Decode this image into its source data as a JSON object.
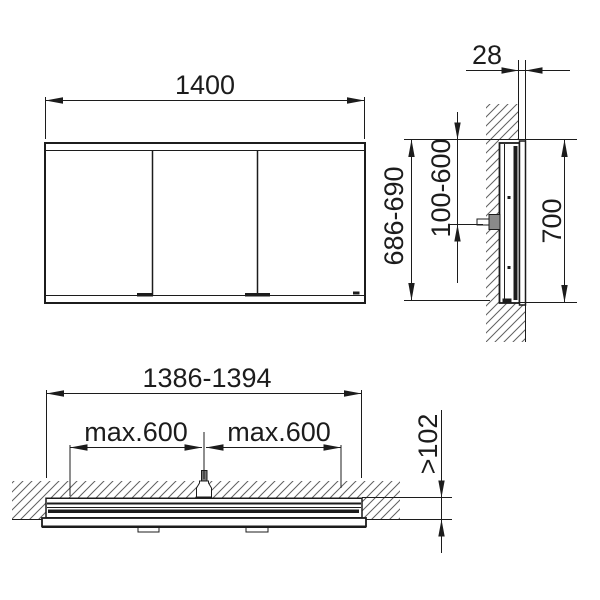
{
  "drawing": {
    "title": "mirror-cabinet-installation-drawing",
    "colors": {
      "line": "#1c1c1c",
      "hatch": "#606060",
      "background": "#ffffff"
    },
    "front_view": {
      "width_label": "1400"
    },
    "side_view": {
      "front_protrusion_label": "28",
      "niche_height_label": "686-690",
      "connection_height_label": "100-600",
      "cabinet_height_label": "700"
    },
    "plan_view": {
      "niche_width_label": "1386-1394",
      "fixing_left_label": "max.600",
      "fixing_right_label": "max.600",
      "niche_depth_label": "&gt;102"
    }
  }
}
